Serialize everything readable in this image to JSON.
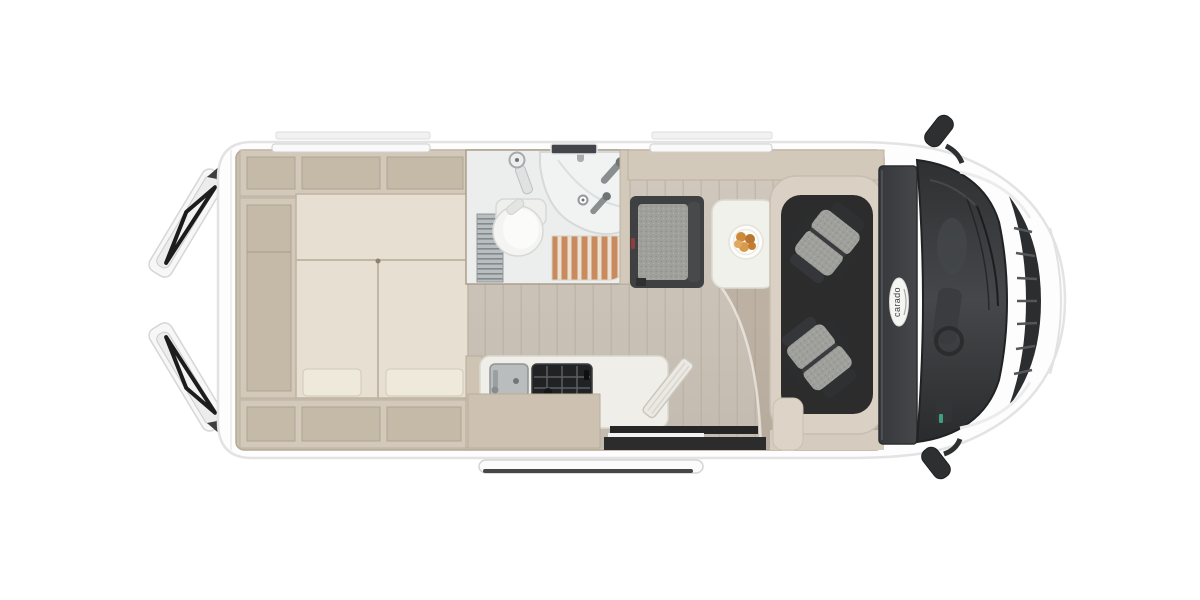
{
  "image": {
    "type": "motorhome-floorplan-top-view",
    "background_color": "#ffffff"
  },
  "brand": {
    "logo_text": "carado"
  },
  "palette": {
    "body_white": "#fdfdfd",
    "body_outline": "#e3e3e3",
    "wall_beige": "#d3c9ba",
    "cabinet_inner": "#c5b9a7",
    "bed_upholstery": "#e6dfd2",
    "floor_wood_light": "#d1c9be",
    "floor_wood_dark": "#c3bbaf",
    "bathroom_white": "#f1f3f3",
    "shower_slats_orange": "#c98a5e",
    "seat_fabric_gray": "#9f9f9c",
    "seat_frame_dark": "#2f3032",
    "dashboard_dark": "#3f4144",
    "table_white": "#f1f1eb",
    "accent_red": "#8f3d3c",
    "sticker_green": "#3f9e7c",
    "food_orange": "#cd8a3e"
  },
  "features": {
    "rear_doors": [
      "rear-door-top",
      "rear-door-bottom"
    ],
    "bedroom": [
      "double-bed",
      "overhead-cabinets",
      "wardrobe-column",
      "under-bed-cabinets",
      "rear-window"
    ],
    "bathroom": [
      "toilet",
      "corner-washbasin",
      "shower-tray",
      "shower-slat-floor",
      "shower-heads",
      "vent-grate",
      "bathroom-window",
      "door-hinge"
    ],
    "kitchen": [
      "kitchen-sink",
      "two-burner-stove",
      "worktop",
      "folding-worktop-extension",
      "kitchen-cabinet"
    ],
    "dinette": [
      "side-bench",
      "dinette-table",
      "breakfast-plate",
      "dinette-window"
    ],
    "cab": [
      "driver-seat",
      "passenger-seat",
      "dashboard",
      "windshield",
      "front-grille",
      "side-mirror-top",
      "side-mirror-bottom",
      "brand-logo"
    ],
    "entrance": [
      "sliding-door-opening",
      "entry-step"
    ]
  }
}
